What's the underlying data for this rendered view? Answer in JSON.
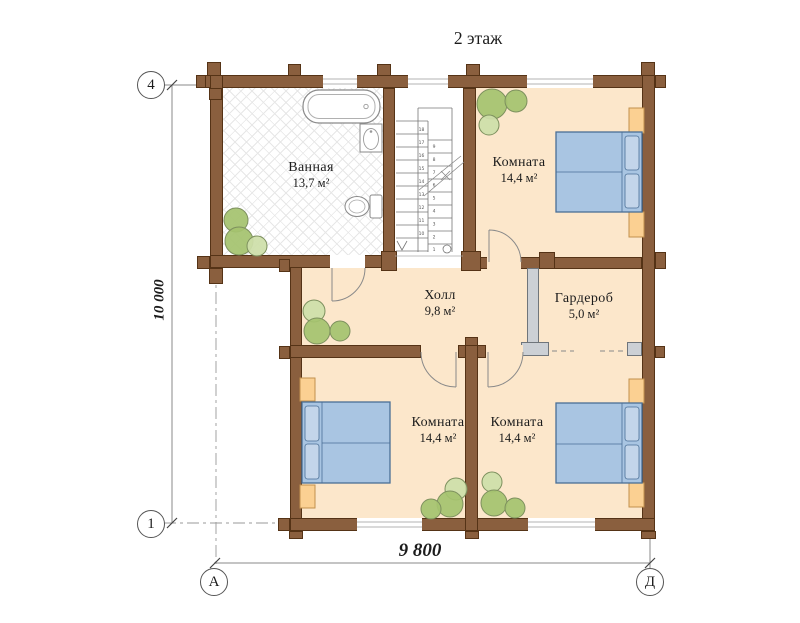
{
  "title": "2 этаж",
  "floor_plan": {
    "rooms": [
      {
        "id": "bathroom",
        "name": "Ванная",
        "area": "13,7 м²"
      },
      {
        "id": "room-top-right",
        "name": "Комната",
        "area": "14,4 м²"
      },
      {
        "id": "hall",
        "name": "Холл",
        "area": "9,8 м²"
      },
      {
        "id": "wardrobe",
        "name": "Гардероб",
        "area": "5,0 м²"
      },
      {
        "id": "room-bottom-left",
        "name": "Комната",
        "area": "14,4 м²"
      },
      {
        "id": "room-bottom-right",
        "name": "Комната",
        "area": "14,4 м²"
      }
    ],
    "axis_markers": {
      "top_left": "4",
      "bottom_left": "1",
      "bottom_col_left": "А",
      "bottom_col_right": "Д"
    },
    "dimensions": {
      "vertical": "10 000",
      "horizontal": "9 800"
    },
    "stairs": {
      "left_numbers": [
        "18",
        "17",
        "16",
        "15",
        "14",
        "13",
        "12",
        "11",
        "10"
      ],
      "right_numbers": [
        "9",
        "8",
        "7",
        "6",
        "5",
        "4",
        "3",
        "2",
        "1"
      ]
    },
    "colors": {
      "wall": "#8a5f3e",
      "wall_outline": "#553316",
      "floor": "#fce7cb",
      "bed": "#a9c5e2",
      "bed_outline": "#4a6f96",
      "pillow": "#c3d5ea",
      "nightstand": "#fbd092",
      "tree_dark": "#a5c36f",
      "tree_light": "#cddfa9",
      "partition": "#ccd0d5",
      "hatch_line": "#e7e7e7"
    }
  }
}
